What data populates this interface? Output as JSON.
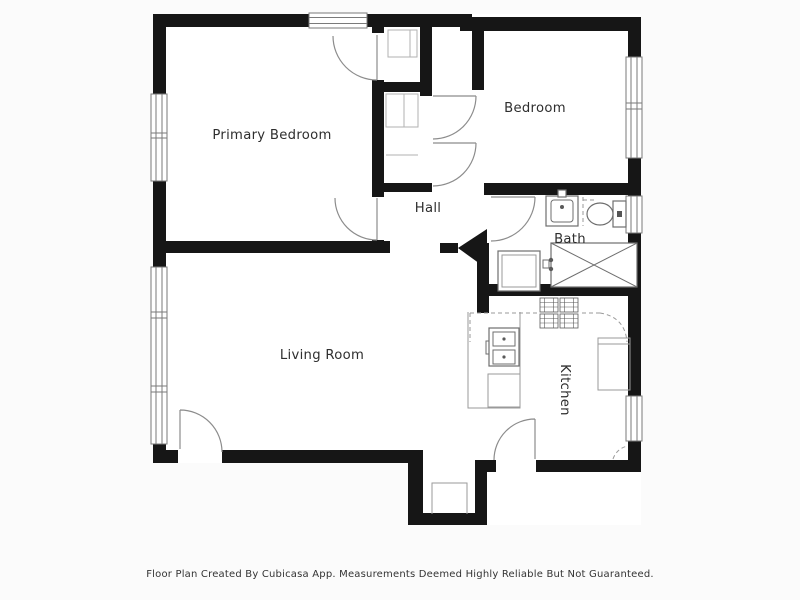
{
  "theme": {
    "page_bg": "#fbfbfb",
    "floor_color": "#ffffff",
    "wall_color": "#161616",
    "door_color": "#8c8c8c",
    "window_color": "#7a7a7a",
    "fixture_color": "#6e6e6e",
    "label_color": "#2e2e2e",
    "footer_color": "#333333"
  },
  "floorplan": {
    "rooms": [
      {
        "id": "primary-bedroom",
        "label": "Primary Bedroom"
      },
      {
        "id": "bedroom",
        "label": "Bedroom"
      },
      {
        "id": "hall",
        "label": "Hall"
      },
      {
        "id": "bath",
        "label": "Bath"
      },
      {
        "id": "living-room",
        "label": "Living Room"
      },
      {
        "id": "kitchen",
        "label": "Kitchen"
      }
    ],
    "fixtures": [
      "bathroom-sink",
      "toilet",
      "shower",
      "washing-machine",
      "shower-valve",
      "stove",
      "kitchen-sink",
      "kitchen-counter",
      "refrigerator",
      "closet-shelves",
      "entry-step"
    ]
  },
  "footer": {
    "text": "Floor Plan Created By Cubicasa App. Measurements Deemed Highly Reliable But Not Guaranteed."
  }
}
